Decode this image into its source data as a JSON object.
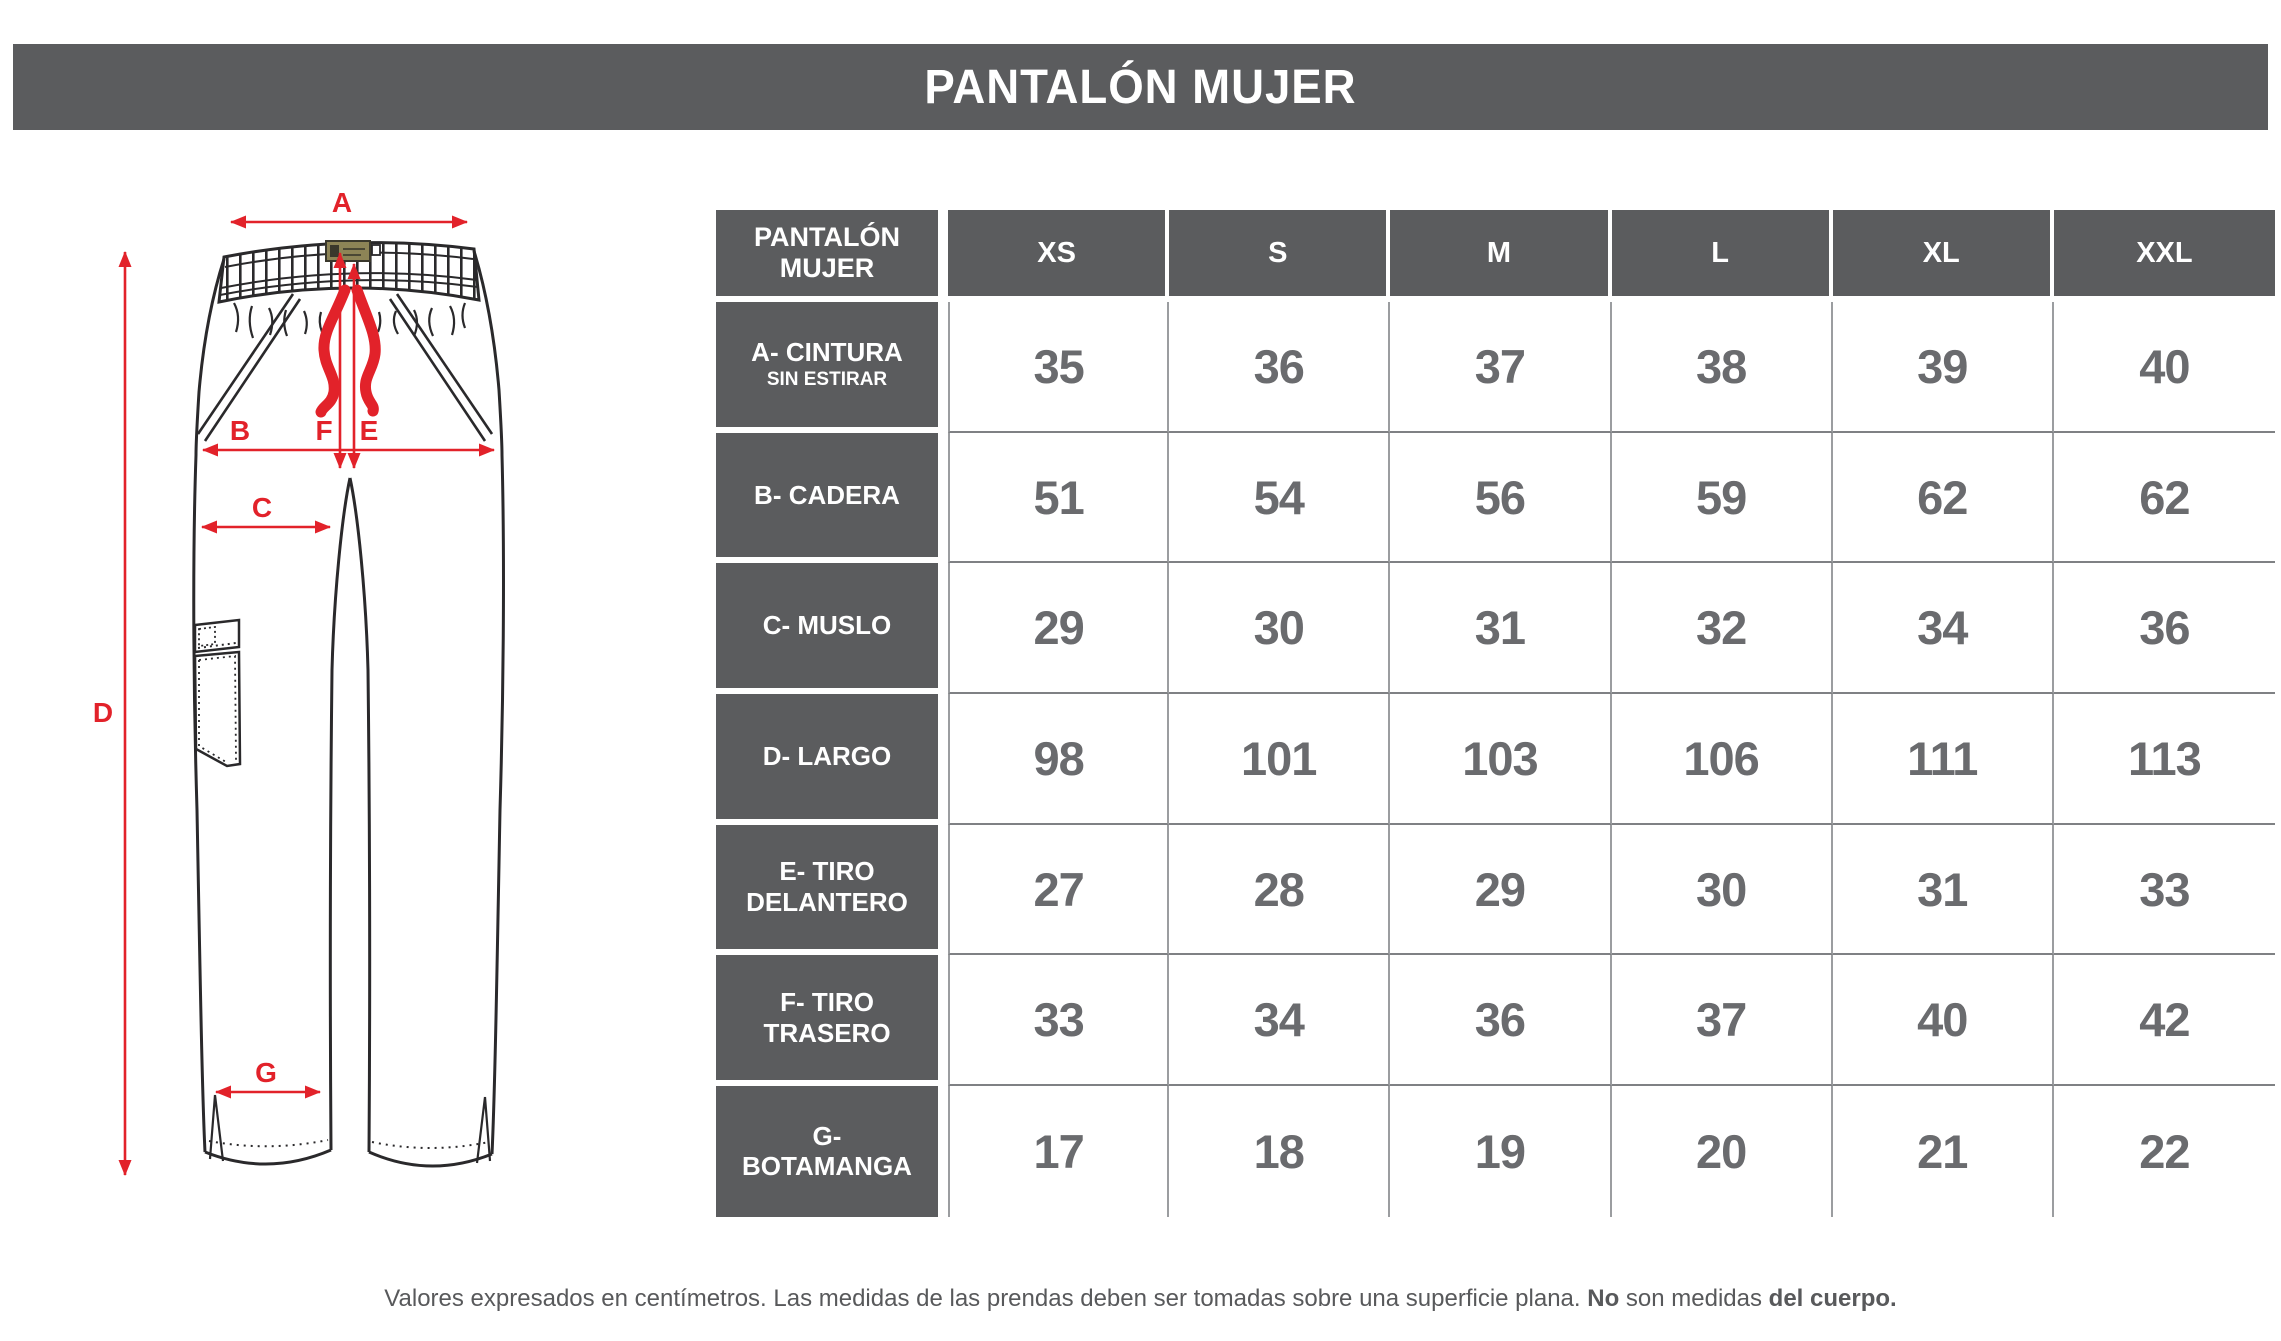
{
  "title_bar": {
    "title": "PANTALÓN MUJER"
  },
  "size_table": {
    "corner_header": "PANTALÓN MUJER",
    "size_headers": [
      "XS",
      "S",
      "M",
      "L",
      "XL",
      "XXL"
    ],
    "rows": [
      {
        "label": "A- CINTURA",
        "sublabel": "SIN ESTIRAR",
        "values": [
          "35",
          "36",
          "37",
          "38",
          "39",
          "40"
        ]
      },
      {
        "label": "B- CADERA",
        "sublabel": "",
        "values": [
          "51",
          "54",
          "56",
          "59",
          "62",
          "62"
        ]
      },
      {
        "label": "C- MUSLO",
        "sublabel": "",
        "values": [
          "29",
          "30",
          "31",
          "32",
          "34",
          "36"
        ]
      },
      {
        "label": "D- LARGO",
        "sublabel": "",
        "values": [
          "98",
          "101",
          "103",
          "106",
          "111",
          "113"
        ]
      },
      {
        "label": "E- TIRO DELANTERO",
        "sublabel": "",
        "values": [
          "27",
          "28",
          "29",
          "30",
          "31",
          "33"
        ]
      },
      {
        "label": "F- TIRO TRASERO",
        "sublabel": "",
        "values": [
          "33",
          "34",
          "36",
          "37",
          "40",
          "42"
        ]
      },
      {
        "label": "G- BOTAMANGA",
        "sublabel": "",
        "values": [
          "17",
          "18",
          "19",
          "20",
          "21",
          "22"
        ]
      }
    ]
  },
  "diagram": {
    "measure_labels": {
      "a": "A",
      "b": "B",
      "c": "C",
      "d": "D",
      "e": "E",
      "f": "F",
      "g": "G"
    },
    "arrow_color": "#e2222a",
    "outline_color": "#2a292b",
    "tag_color": "#8d8456"
  },
  "footer": {
    "normal_1": "Valores expresados en centímetros. Las medidas de las prendas deben ser tomadas sobre una superficie plana. ",
    "bold_1": "No",
    "normal_2": " son medidas ",
    "bold_2": "del cuerpo."
  },
  "chart_data": {
    "type": "table",
    "title": "PANTALÓN MUJER",
    "units": "centímetros",
    "columns": [
      "PANTALÓN MUJER",
      "XS",
      "S",
      "M",
      "L",
      "XL",
      "XXL"
    ],
    "rows": [
      [
        "A- CINTURA SIN ESTIRAR",
        35,
        36,
        37,
        38,
        39,
        40
      ],
      [
        "B- CADERA",
        51,
        54,
        56,
        59,
        62,
        62
      ],
      [
        "C- MUSLO",
        29,
        30,
        31,
        32,
        34,
        36
      ],
      [
        "D- LARGO",
        98,
        101,
        103,
        106,
        111,
        113
      ],
      [
        "E- TIRO DELANTERO",
        27,
        28,
        29,
        30,
        31,
        33
      ],
      [
        "F- TIRO TRASERO",
        33,
        34,
        36,
        37,
        40,
        42
      ],
      [
        "G- BOTAMANGA",
        17,
        18,
        19,
        20,
        21,
        22
      ]
    ]
  }
}
